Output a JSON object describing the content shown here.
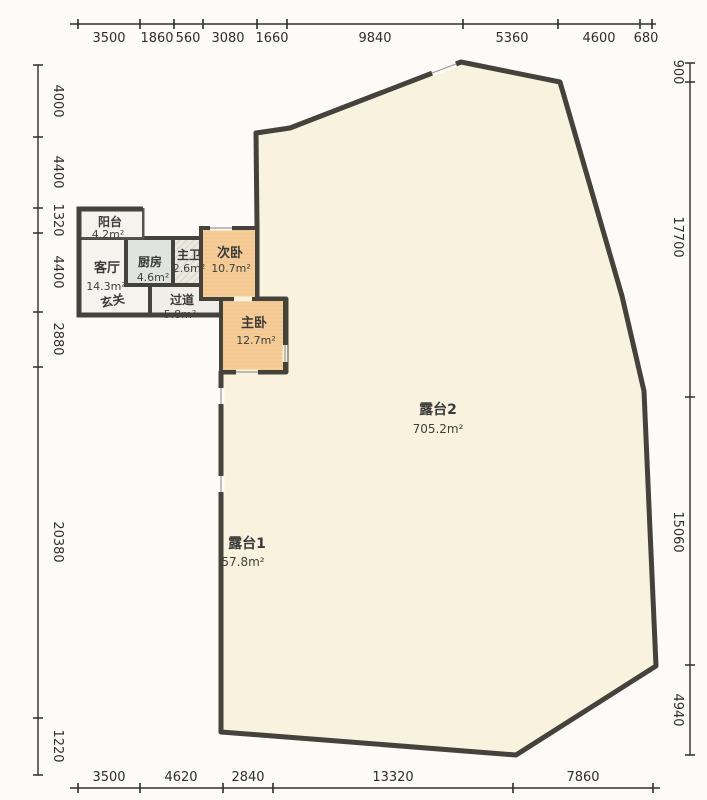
{
  "plan_title": "residential floor plan with terraces",
  "colors": {
    "wall": "#44423a",
    "terrace_fill": "#f9f2de",
    "bedroom_fill": "#f6cd98",
    "kitchen_fill": "#dfe5de",
    "bath_fill": "#ece9e1",
    "living_fill": "#f4f3ee",
    "hall_fill": "#f0eee8",
    "dimension_text": "#2e2e2e",
    "window_line": "#9a9a92"
  },
  "dimensions": {
    "top": [
      "3500",
      "1860",
      "560",
      "3080",
      "1660",
      "9840",
      "5360",
      "4600",
      "680"
    ],
    "left": [
      "4000",
      "4400",
      "1320",
      "4400",
      "2880",
      "20380",
      "1220"
    ],
    "right": [
      "900",
      "17700",
      "15060",
      "4940"
    ],
    "bottom": [
      "3500",
      "4620",
      "2840",
      "13320",
      "7860"
    ]
  },
  "rooms": {
    "balcony": {
      "name": "阳台",
      "area": "4.2m²"
    },
    "living": {
      "name": "客厅",
      "area": "14.3m²"
    },
    "foyer": {
      "name": "玄关"
    },
    "kitchen": {
      "name": "厨房",
      "area": "4.6m²"
    },
    "master_bath": {
      "name": "主卫",
      "area": "2.6m²"
    },
    "hallway": {
      "name": "过道",
      "area": "5.8m²"
    },
    "second_bedroom": {
      "name": "次卧",
      "area": "10.7m²"
    },
    "master_bedroom": {
      "name": "主卧",
      "area": "12.7m²"
    },
    "terrace2": {
      "name": "露台2",
      "area": "705.2m²"
    },
    "terrace1": {
      "name": "露台1",
      "area": "57.8m²"
    }
  }
}
